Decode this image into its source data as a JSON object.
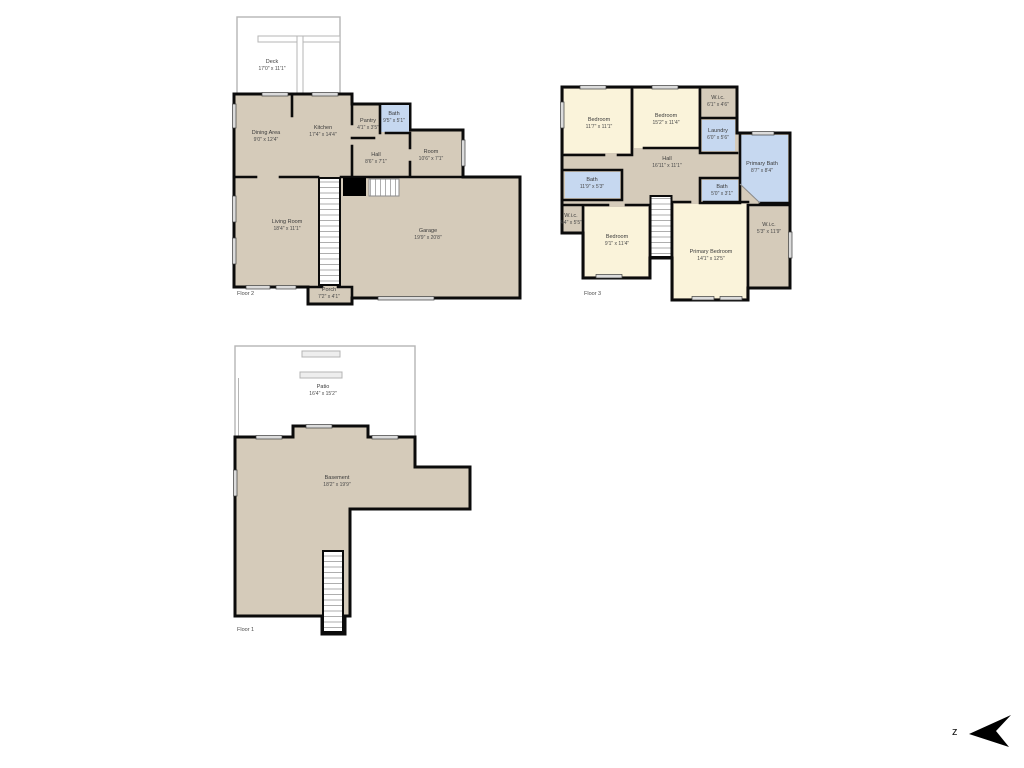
{
  "colors": {
    "floor_fill": "#d5cbba",
    "bedroom_fill": "#faf3da",
    "bath_fill": "#c6d8f0",
    "wall": "#000000",
    "outdoor_outline": "#b5b5b5"
  },
  "compass": {
    "letter": "z"
  },
  "floors": [
    {
      "label": "Floor 2",
      "rooms": {
        "deck": {
          "name": "Deck",
          "dims": "17'0\" x 11'1\""
        },
        "dining": {
          "name": "Dining Area",
          "dims": "9'0\" x 12'4\""
        },
        "kitchen": {
          "name": "Kitchen",
          "dims": "17'4\" x 14'4\""
        },
        "pantry": {
          "name": "Pantry",
          "dims": "4'1\" x 3'5\""
        },
        "bath": {
          "name": "Bath",
          "dims": "9'5\" x 5'1\""
        },
        "hall": {
          "name": "Hall",
          "dims": "8'6\" x 7'1\""
        },
        "room": {
          "name": "Room",
          "dims": "10'6\" x 7'1\""
        },
        "living": {
          "name": "Living Room",
          "dims": "18'4\" x 11'1\""
        },
        "garage": {
          "name": "Garage",
          "dims": "19'9\" x 20'8\""
        },
        "porch": {
          "name": "Porch",
          "dims": "7'2\" x 4'1\""
        }
      }
    },
    {
      "label": "Floor 3",
      "rooms": {
        "bedroom_a": {
          "name": "Bedroom",
          "dims": "11'7\" x 11'1\""
        },
        "bedroom_b": {
          "name": "Bedroom",
          "dims": "15'2\" x 11'4\""
        },
        "wic_top": {
          "name": "W.i.c.",
          "dims": "6'1\" x 4'6\""
        },
        "laundry": {
          "name": "Laundry",
          "dims": "6'0\" x 5'6\""
        },
        "primary_bath": {
          "name": "Primary Bath",
          "dims": "8'7\" x 8'4\""
        },
        "hall": {
          "name": "Hall",
          "dims": "16'11\" x 11'1\""
        },
        "bath_left": {
          "name": "Bath",
          "dims": "11'9\" x 5'3\""
        },
        "bath_small": {
          "name": "Bath",
          "dims": "5'0\" x 3'1\""
        },
        "wic_left": {
          "name": "W.i.c.",
          "dims": "4'4\" x 5'5\""
        },
        "bedroom_c": {
          "name": "Bedroom",
          "dims": "9'1\" x 11'4\""
        },
        "primary_bedroom": {
          "name": "Primary Bedroom",
          "dims": "14'1\" x 12'5\""
        },
        "wic_right": {
          "name": "W.i.c.",
          "dims": "5'3\" x 11'9\""
        }
      }
    },
    {
      "label": "Floor 1",
      "rooms": {
        "patio": {
          "name": "Patio",
          "dims": "16'4\" x 15'2\""
        },
        "basement": {
          "name": "Basement",
          "dims": "18'2\" x 19'9\""
        }
      }
    }
  ]
}
